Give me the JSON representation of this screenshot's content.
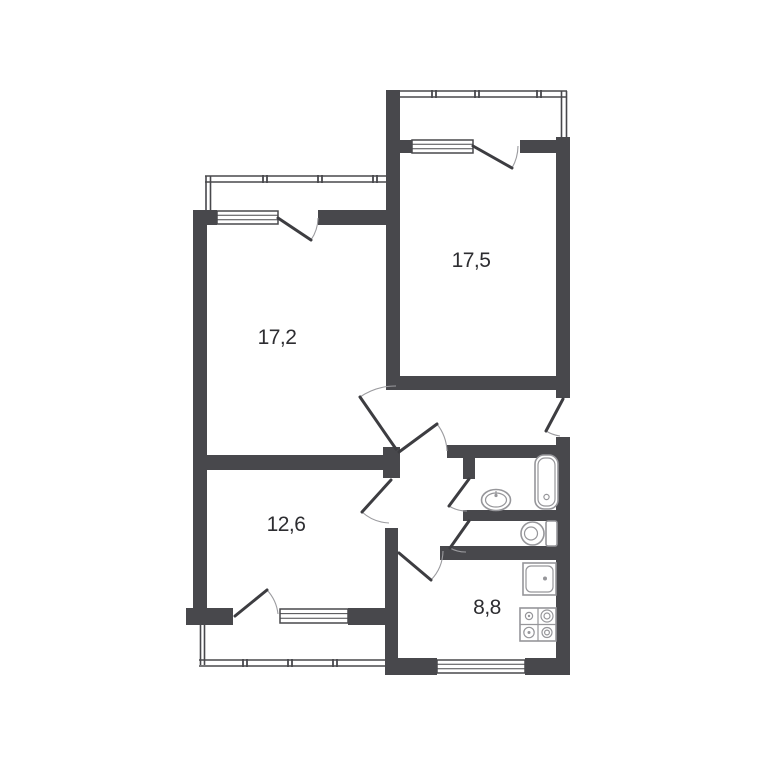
{
  "plan": {
    "rooms": [
      {
        "id": "room-top-right",
        "area": "17,5"
      },
      {
        "id": "room-top-left",
        "area": "17,2"
      },
      {
        "id": "room-bottom-left",
        "area": "12,6"
      },
      {
        "id": "kitchen",
        "area": "8,8"
      }
    ],
    "fixtures": [
      "bathtub",
      "wash-basin",
      "toilet",
      "kitchen-sink",
      "stove-4-burner"
    ],
    "features": [
      "balcony-top-right",
      "balcony-top-left",
      "balcony-bottom-left",
      "entrance-door-right",
      "bathroom",
      "toilet-room",
      "hallway",
      "corridor"
    ],
    "colors": {
      "wall": "#48484c",
      "door": "#3d3d41",
      "arc": "#9b9b9f",
      "fixture": "#96969a",
      "text": "#2d2d31",
      "bg": "#ffffff"
    }
  }
}
